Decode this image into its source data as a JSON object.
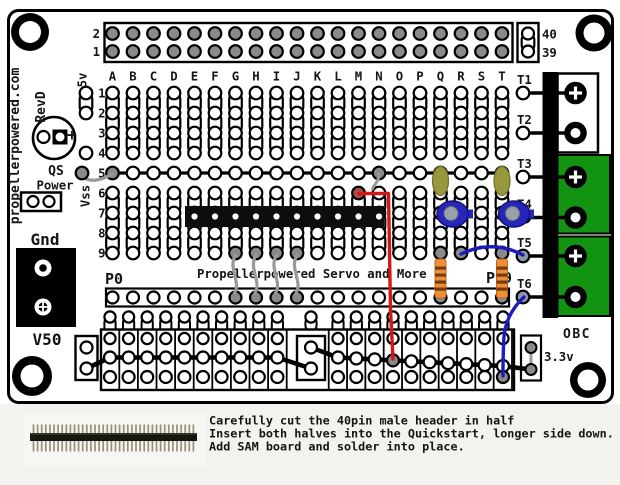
{
  "board": {
    "site": "propellerpowered.com",
    "rev": "RevD",
    "top_header": {
      "row_labels": [
        "2",
        "1"
      ],
      "pin_labels": [
        "40",
        "39"
      ]
    },
    "column_letters": [
      "A",
      "B",
      "C",
      "D",
      "E",
      "F",
      "G",
      "H",
      "I",
      "J",
      "K",
      "L",
      "M",
      "N",
      "O",
      "P",
      "Q",
      "R",
      "S",
      "T"
    ],
    "row_numbers": [
      "1",
      "2",
      "3",
      "4",
      "5",
      "6",
      "7",
      "8",
      "9"
    ],
    "left_labels": {
      "v5": "5v",
      "plus": "+",
      "qs": "QS",
      "power": "Power",
      "vss": "Vss",
      "gnd": "Gnd",
      "v50": "V50"
    },
    "strip_labels": {
      "p0": "P0",
      "p9": "P9"
    },
    "title": "Propellerpowered Servo and More",
    "terminal_labels": [
      "T1",
      "T2",
      "T3",
      "T4",
      "T5",
      "T6"
    ],
    "right_labels": {
      "obc": "OBC",
      "v33": "3.3v"
    },
    "colors": {
      "green": "#129312",
      "cap_blue": "#2626b8",
      "cap_olive": "#97973d",
      "resistor": "#ef9038",
      "resistor_stripe": "#7a3a10",
      "wire_red": "#d01818",
      "wire_blue": "#1c1cbe",
      "wire_gray": "#999999",
      "pad_gray": "#8a8a8a",
      "pin_tan": "#9a8f78"
    }
  },
  "instructions": {
    "line1": "Carefully cut the 40pin male header in half",
    "line2": "Insert both halves into the Quickstart, longer side down.",
    "line3": "Add SAM board and solder into place."
  }
}
